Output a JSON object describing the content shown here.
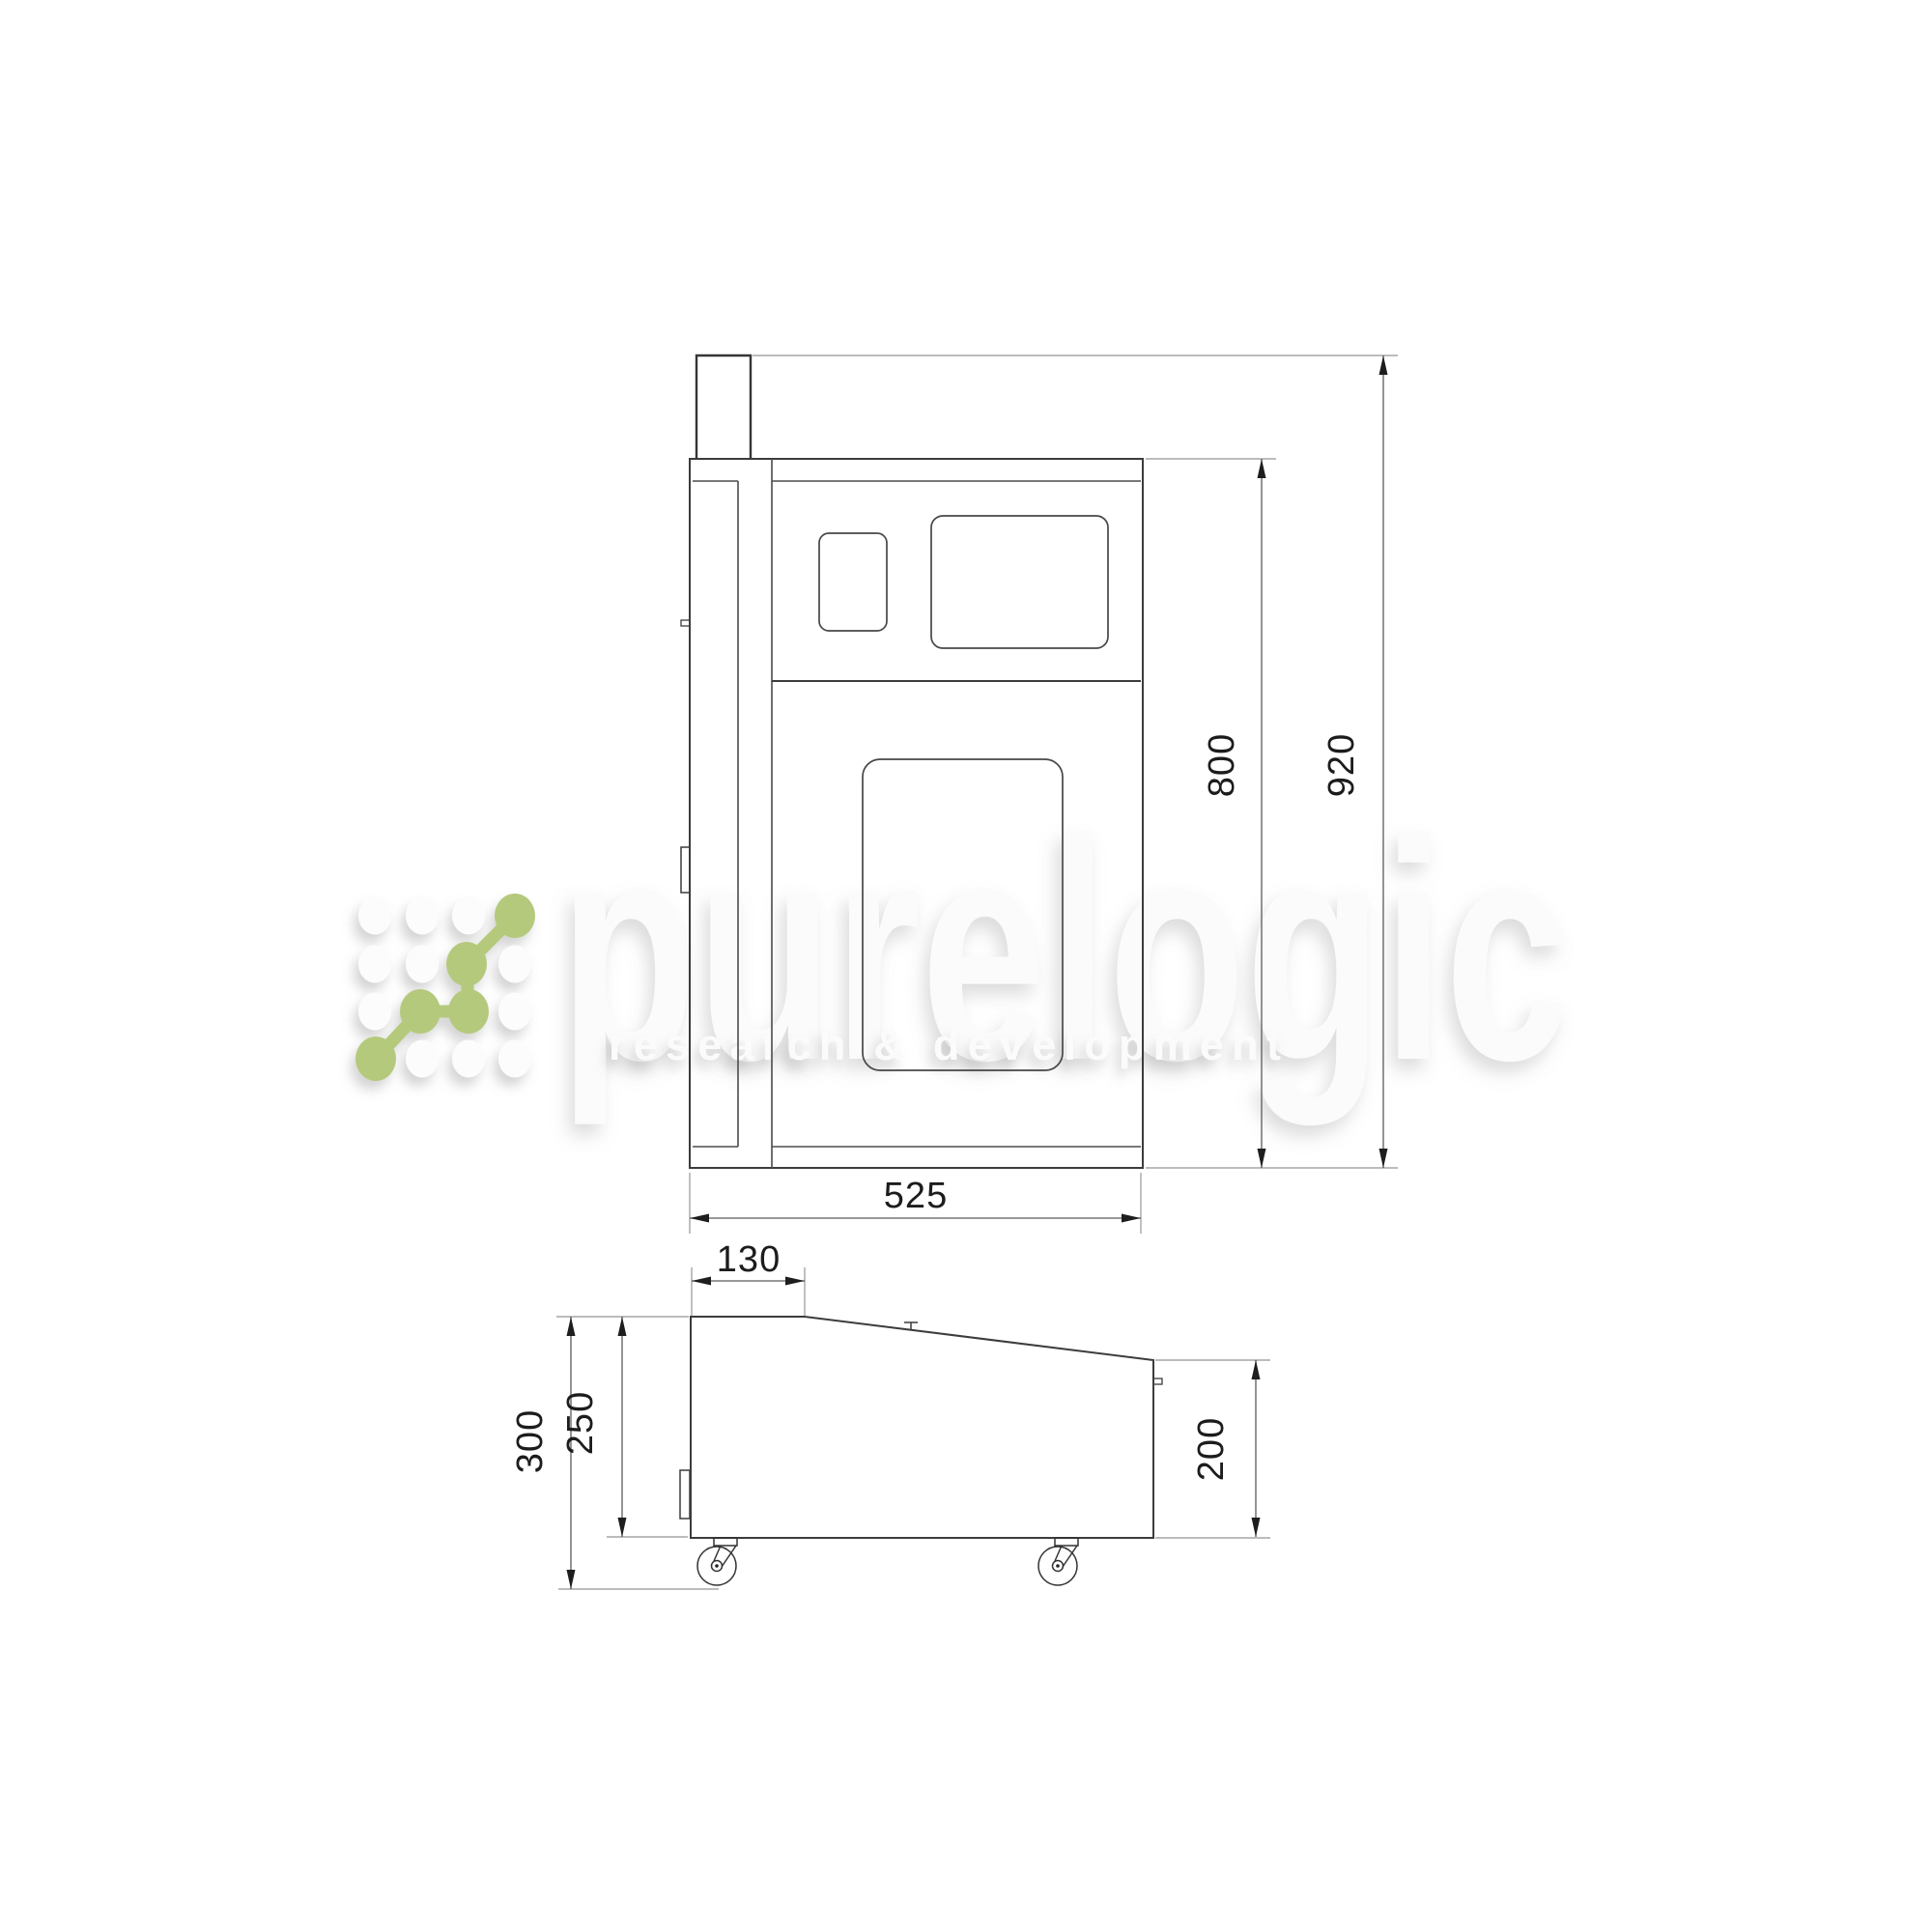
{
  "watermark": {
    "brand": "purelogic",
    "tagline": "research & development",
    "accent_color": "#b5c97c"
  },
  "front_view_dims": {
    "width": "525",
    "body_height": "800",
    "total_height": "920"
  },
  "side_view_dims": {
    "top_flat_depth": "130",
    "total_height": "300",
    "body_height": "250",
    "rear_height": "200"
  }
}
